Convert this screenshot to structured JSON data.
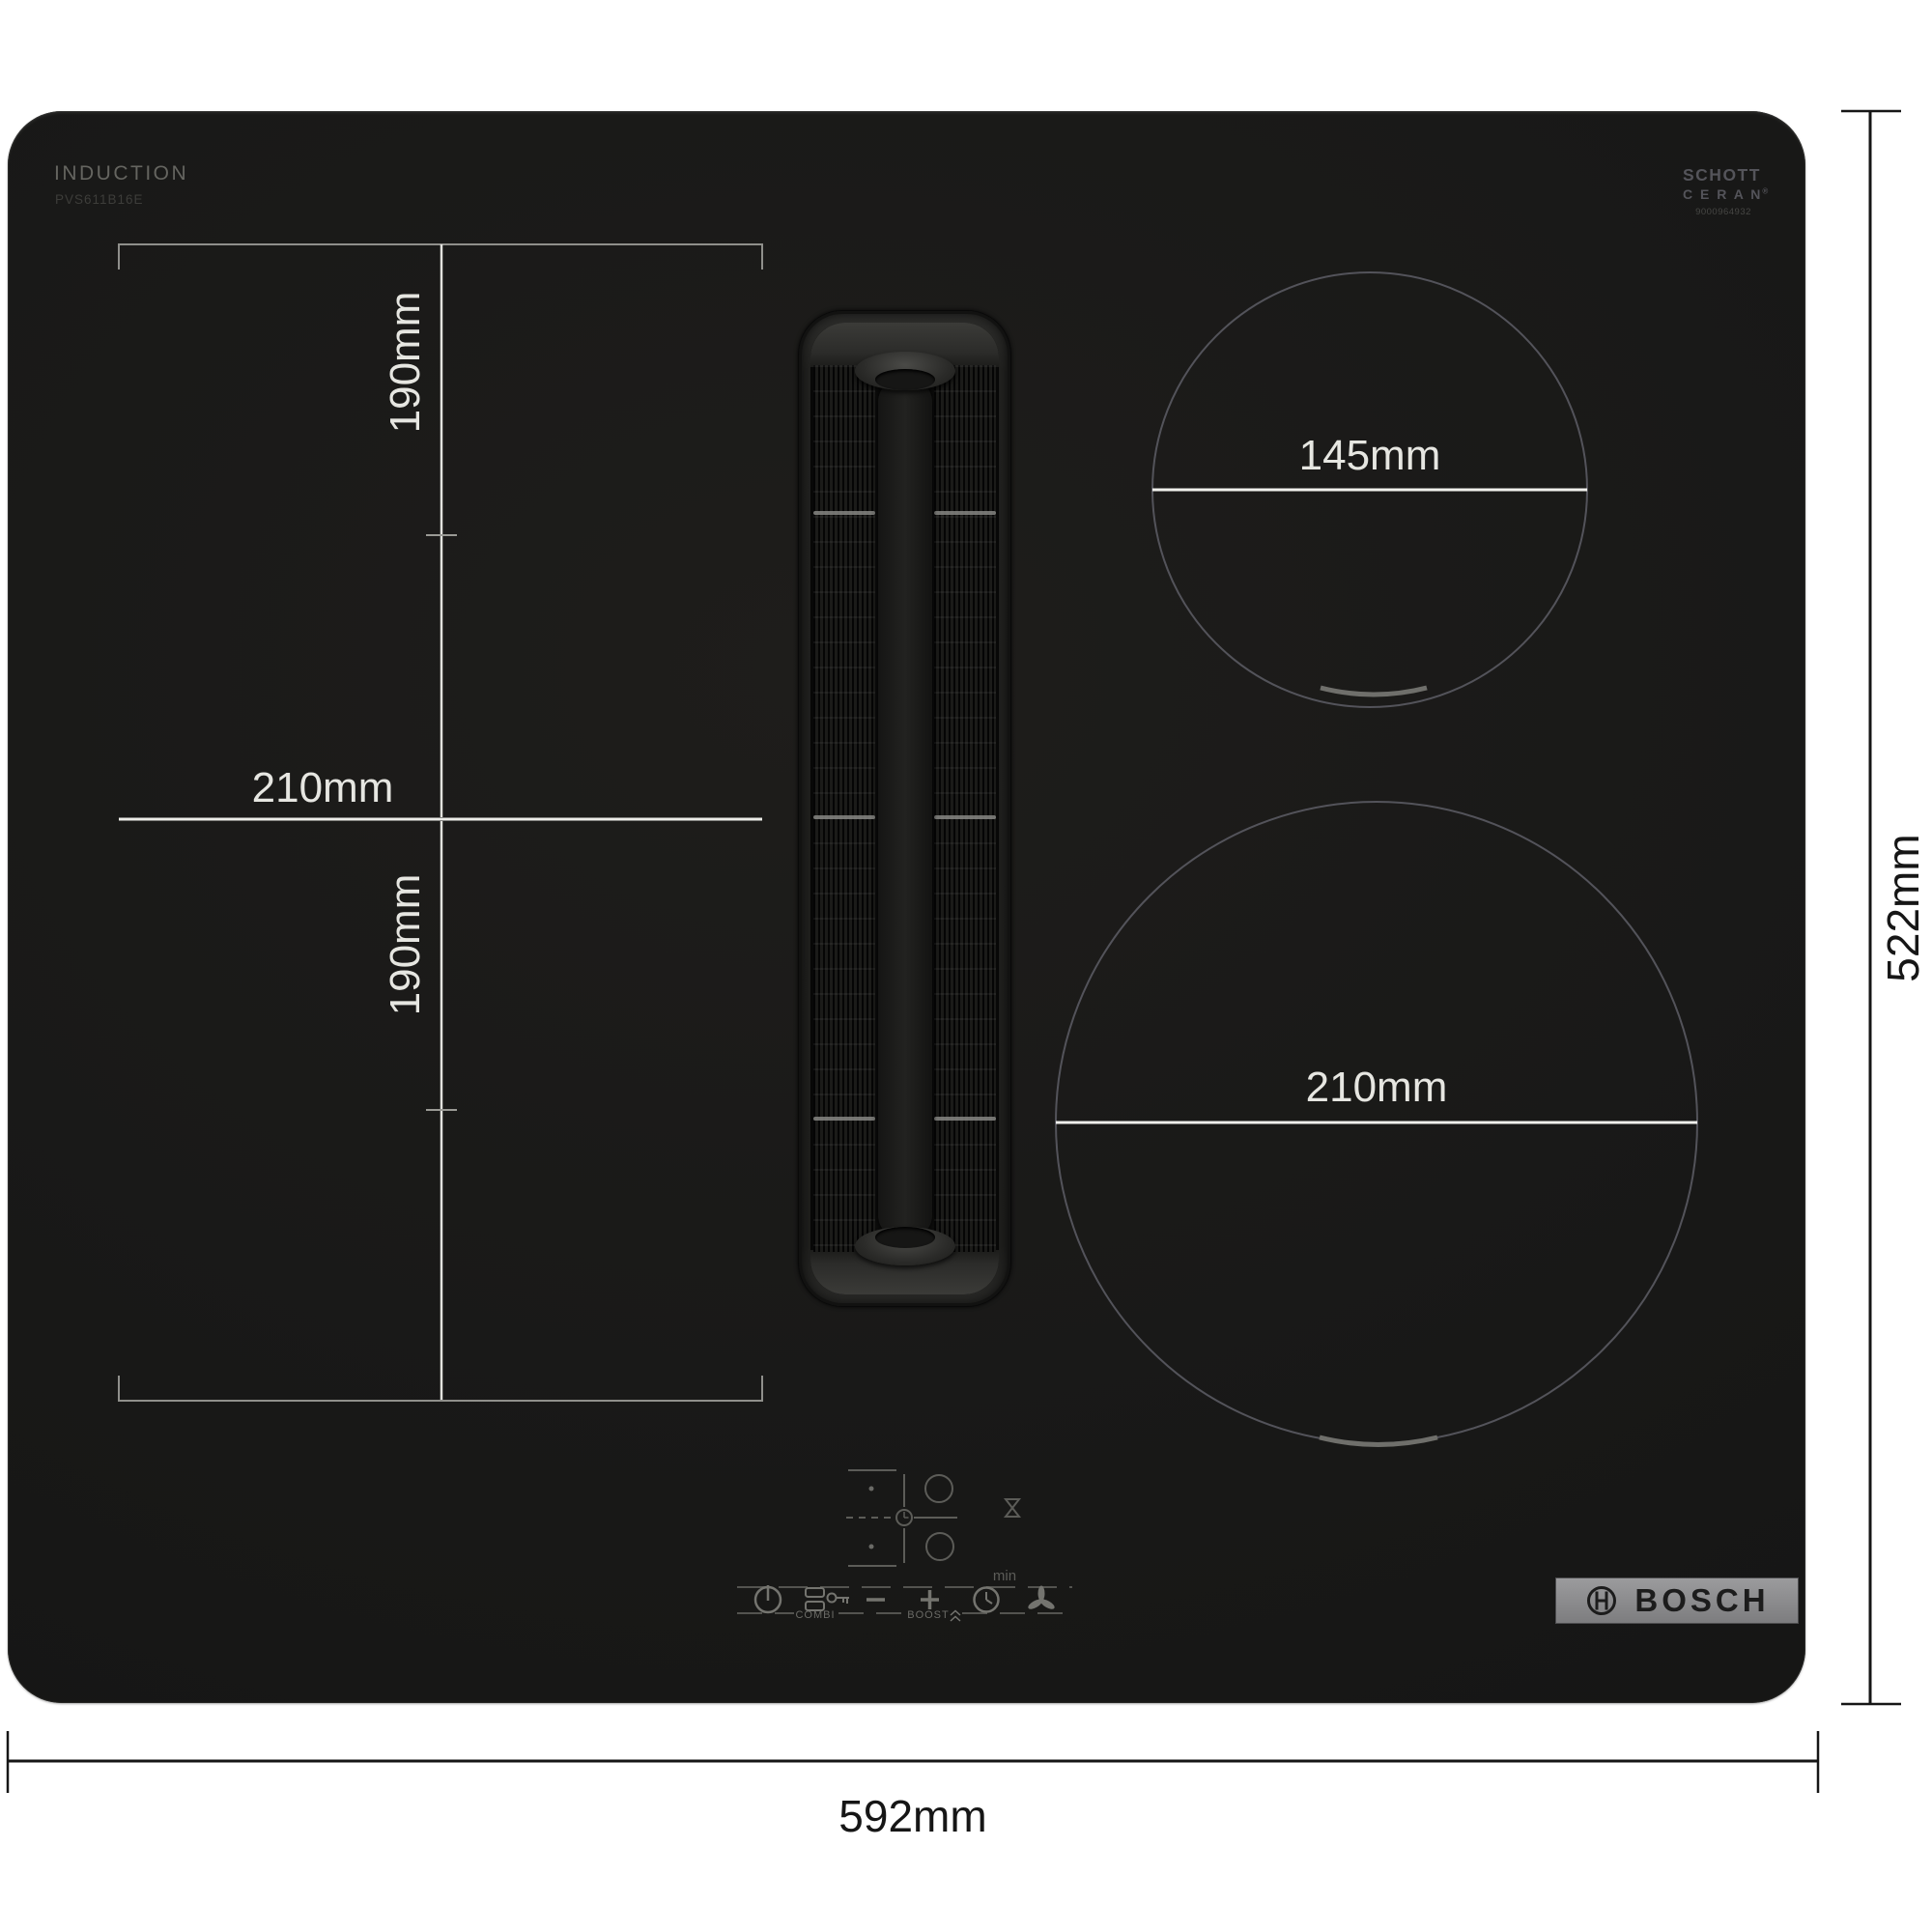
{
  "branding": {
    "type_label": "INDUCTION",
    "model_number": "PVS611B16E",
    "glass_brand": {
      "line1": "SCHOTT",
      "line2": "C E R A N",
      "registered": "®",
      "part_number": "9000964932"
    },
    "logo_text": "BOSCH"
  },
  "zone_dimensions": {
    "left_top_zone_depth": "190mm",
    "left_zone_width": "210mm",
    "left_bottom_zone_depth": "190mm",
    "right_top_zone_diameter": "145mm",
    "right_bottom_zone_diameter": "210mm"
  },
  "overall_dimensions": {
    "width": "592mm",
    "depth": "522mm"
  },
  "control_panel": {
    "combi_label": "COMBI",
    "boost_label": "BOOST",
    "min_label": "min",
    "icon_names": [
      "power-icon",
      "flex-zone-icon",
      "key-lock-icon",
      "minus-icon",
      "plus-icon",
      "boost-chevrons-icon",
      "timer-icon",
      "fan-icon",
      "hourglass-icon",
      "zone-selector-clock-icon"
    ]
  },
  "colors": {
    "background": "#ffffff",
    "hob_surface": "#1a1a18",
    "hob_dimension_lines": "#e9e9e5",
    "hob_bracket_lines": "#8f8f8b",
    "zone_outline": "#53535a",
    "outer_dimension_lines": "#161616",
    "bosch_badge_background": "#8d8d8f",
    "control_icon_color": "#74746f"
  }
}
